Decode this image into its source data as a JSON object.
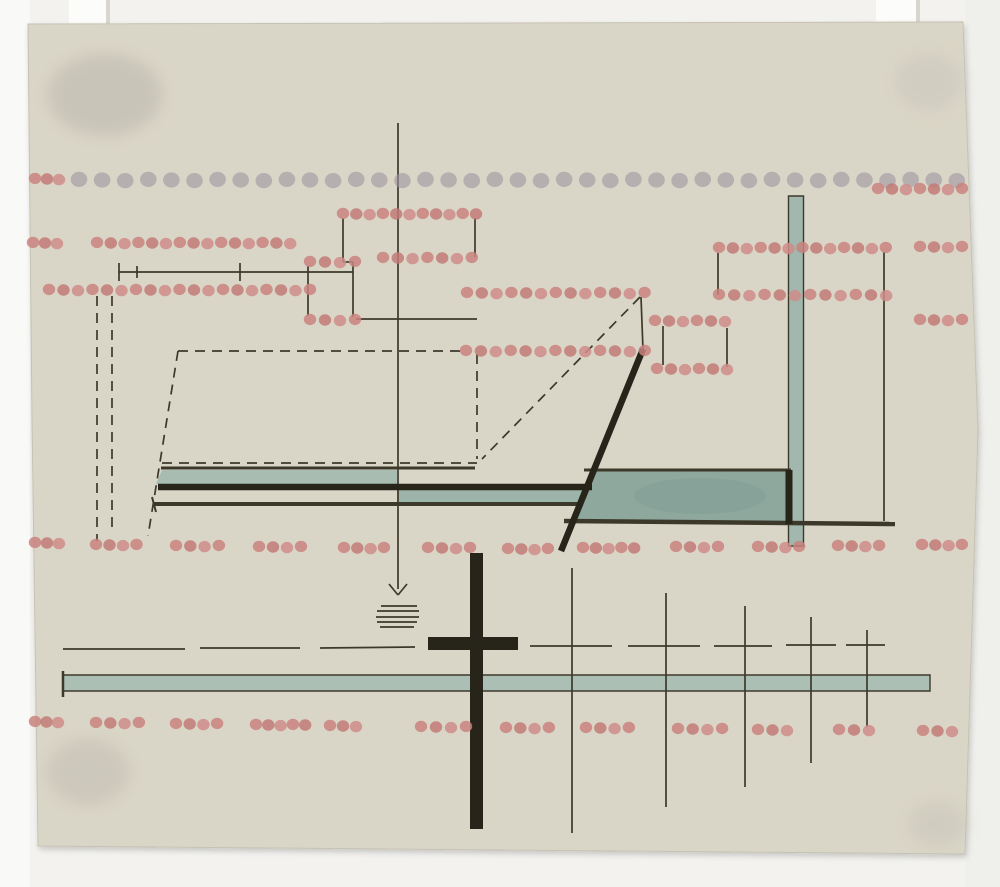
{
  "artwork": {
    "scene": {
      "width": 1000,
      "height": 887,
      "background": "#f3f2ef",
      "left_strip": "#fafaf8",
      "right_strip": "#eeedea"
    },
    "palette": {
      "ink": "#3c392b",
      "black": "#272419",
      "pink": "#c9837e",
      "pink_dark": "#c17a75",
      "pink_light": "#cf8d89",
      "gray_dot": "#9d94a0",
      "tab": "#fcfcfa",
      "tab_shadow": "#d9d6d0",
      "paper": "#dad6c7",
      "paper_edge": "#c6c2b3"
    },
    "tabs": [
      {
        "x": 69,
        "y": 0,
        "w": 41,
        "h": 28
      },
      {
        "x": 876,
        "y": 0,
        "w": 44,
        "h": 25
      }
    ],
    "paper": {
      "points": "28,24 963,22 978,430 965,854 38,846 32,420",
      "fill": "#dad6c7",
      "edge": "#c6c2b3"
    },
    "smudges": [
      {
        "cx": 105,
        "cy": 95,
        "rx": 58,
        "ry": 42,
        "fill": "#b5b0a8",
        "op": 0.45
      },
      {
        "cx": 88,
        "cy": 772,
        "rx": 42,
        "ry": 34,
        "fill": "#bdb8ae",
        "op": 0.45
      },
      {
        "cx": 928,
        "cy": 82,
        "rx": 34,
        "ry": 30,
        "fill": "#c9c5bc",
        "op": 0.5
      },
      {
        "cx": 937,
        "cy": 824,
        "rx": 30,
        "ry": 24,
        "fill": "#c6c2b8",
        "op": 0.45
      }
    ],
    "teal_shapes": [
      {
        "name": "teal-column",
        "pts": "788.5,196 803.5,196 803.5,546 788.5,546",
        "fill": "#a2b7ad",
        "stroke": true
      },
      {
        "name": "teal-bar-left",
        "pts": "162,470 397,470 397,484 156,484",
        "fill": "#a9bcb2",
        "stroke": false
      },
      {
        "name": "teal-bar-mid",
        "pts": "397,489 583,489 583,502 397,502",
        "fill": "#9cb4aa",
        "stroke": false
      },
      {
        "name": "teal-panel",
        "pts": "594,470 790,470 790,521 573,521",
        "fill": "#8ea89e",
        "stroke": false
      },
      {
        "name": "teal-bar-long",
        "pts": "63,675 930,675 930,691 63,691",
        "fill": "#abbfb4",
        "stroke": true
      }
    ],
    "teal_blotch": {
      "cx": 700,
      "cy": 496,
      "rx": 66,
      "ry": 18,
      "fill": "#7d9b93",
      "op": 0.5
    },
    "black_rects": [
      {
        "name": "cross-vertical-bar",
        "x": 470,
        "y": 553,
        "w": 13,
        "h": 276
      },
      {
        "name": "cross-horizontal-bar",
        "x": 428,
        "y": 637,
        "w": 90,
        "h": 13
      }
    ],
    "lines": {
      "solid": [
        [
          398,
          123,
          398,
          589
        ],
        [
          389,
          584,
          398,
          595
        ],
        [
          407,
          584,
          398,
          595
        ],
        [
          381,
          606,
          417,
          606
        ],
        [
          377,
          611,
          419,
          611
        ],
        [
          376,
          617,
          419,
          617
        ],
        [
          377,
          622,
          417,
          622
        ],
        [
          380,
          627,
          414,
          627
        ],
        [
          119,
          272,
          353,
          272
        ],
        [
          119,
          263,
          119,
          281
        ],
        [
          137,
          266,
          137,
          278
        ],
        [
          240,
          263,
          240,
          281
        ],
        [
          343,
          218,
          343,
          262
        ],
        [
          343,
          262,
          353,
          262
        ],
        [
          353,
          262,
          353,
          317
        ],
        [
          308,
          266,
          308,
          316
        ],
        [
          475,
          218,
          475,
          257
        ],
        [
          356,
          319,
          477,
          319
        ],
        [
          641,
          297,
          643,
          350
        ],
        [
          718,
          253,
          718,
          295
        ],
        [
          884,
          252,
          884,
          521
        ],
        [
          663,
          326,
          663,
          365
        ],
        [
          727,
          328,
          727,
          367
        ],
        [
          572,
          568,
          572,
          833
        ],
        [
          666,
          593,
          666,
          807
        ],
        [
          745,
          606,
          745,
          787
        ],
        [
          811,
          617,
          811,
          763
        ],
        [
          867,
          630,
          867,
          727
        ],
        [
          63,
          649,
          185,
          649
        ],
        [
          200,
          648,
          300,
          648
        ],
        [
          320,
          648,
          415,
          647
        ],
        [
          530,
          646,
          612,
          646
        ],
        [
          628,
          646,
          700,
          646
        ],
        [
          714,
          646,
          772,
          646
        ],
        [
          786,
          645,
          836,
          645
        ],
        [
          846,
          645,
          885,
          645
        ],
        [
          161,
          468,
          475,
          468,
          3
        ],
        [
          153,
          504,
          583,
          504,
          4
        ],
        [
          152,
          497,
          156,
          512,
          2
        ],
        [
          564,
          521,
          895,
          524,
          4.5
        ],
        [
          584,
          470,
          791,
          470,
          3
        ],
        [
          63,
          671,
          63,
          697,
          2.5
        ]
      ],
      "dashed": [
        [
          97,
          296,
          97,
          541
        ],
        [
          112,
          296,
          112,
          527
        ],
        [
          178,
          351,
          462,
          351
        ],
        [
          178,
          351,
          148,
          536
        ],
        [
          477,
          354,
          477,
          459
        ],
        [
          640,
          297,
          482,
          459
        ],
        [
          162,
          463,
          477,
          463
        ]
      ],
      "black": [
        [
          158,
          487,
          592,
          487,
          6.5
        ],
        [
          643,
          349,
          561,
          551,
          6.5
        ],
        [
          789,
          470,
          789,
          524,
          7
        ]
      ]
    },
    "dot_rows": [
      {
        "c": "gray",
        "y": 180,
        "x": 79,
        "n": 39,
        "dx": 23.1,
        "d": 16.6
      },
      {
        "c": "pink",
        "y": 179,
        "x": 35,
        "n": 3,
        "dx": 12,
        "d": 12.4
      },
      {
        "c": "pink",
        "y": 189,
        "x": 878,
        "n": 7,
        "dx": 14,
        "d": 12.4
      },
      {
        "c": "pink",
        "y": 214,
        "x": 343,
        "n": 11,
        "dx": 13.3,
        "d": 12.4
      },
      {
        "c": "pink",
        "y": 243,
        "x": 33,
        "n": 3,
        "dx": 12,
        "d": 12.4
      },
      {
        "c": "pink",
        "y": 243,
        "x": 97,
        "n": 15,
        "dx": 13.8,
        "d": 12.4
      },
      {
        "c": "pink",
        "y": 248,
        "x": 719,
        "n": 13,
        "dx": 13.9,
        "d": 12.4
      },
      {
        "c": "pink",
        "y": 247,
        "x": 920,
        "n": 4,
        "dx": 14,
        "d": 12.4
      },
      {
        "c": "pink",
        "y": 258,
        "x": 383,
        "n": 7,
        "dx": 14.8,
        "d": 12.4
      },
      {
        "c": "pink",
        "y": 262,
        "x": 310,
        "n": 4,
        "dx": 15,
        "d": 12.4
      },
      {
        "c": "pink",
        "y": 290,
        "x": 49,
        "n": 19,
        "dx": 14.5,
        "d": 12.4
      },
      {
        "c": "pink",
        "y": 293,
        "x": 467,
        "n": 13,
        "dx": 14.8,
        "d": 12.4
      },
      {
        "c": "pink",
        "y": 295,
        "x": 719,
        "n": 12,
        "dx": 15.2,
        "d": 12.4
      },
      {
        "c": "pink",
        "y": 320,
        "x": 310,
        "n": 4,
        "dx": 15,
        "d": 12.4
      },
      {
        "c": "pink",
        "y": 321,
        "x": 655,
        "n": 6,
        "dx": 14,
        "d": 12.4
      },
      {
        "c": "pink",
        "y": 320,
        "x": 920,
        "n": 4,
        "dx": 14,
        "d": 12.4
      },
      {
        "c": "pink",
        "y": 351,
        "x": 466,
        "n": 13,
        "dx": 14.9,
        "d": 12.4
      },
      {
        "c": "pink",
        "y": 369,
        "x": 657,
        "n": 6,
        "dx": 14,
        "d": 12.4
      },
      {
        "c": "pink",
        "y": 543,
        "x": 35,
        "n": 3,
        "dx": 12,
        "d": 12.4
      },
      {
        "c": "pink",
        "y": 545,
        "x": 96,
        "n": 4,
        "dx": 13.5,
        "d": 12.4
      },
      {
        "c": "pink",
        "y": 546,
        "x": 176,
        "n": 4,
        "dx": 14.3,
        "d": 12.4
      },
      {
        "c": "pink",
        "y": 547,
        "x": 259,
        "n": 4,
        "dx": 14,
        "d": 12.4
      },
      {
        "c": "pink",
        "y": 548,
        "x": 344,
        "n": 4,
        "dx": 13.3,
        "d": 12.4
      },
      {
        "c": "pink",
        "y": 548,
        "x": 428,
        "n": 4,
        "dx": 14,
        "d": 12.4
      },
      {
        "c": "pink",
        "y": 549,
        "x": 508,
        "n": 4,
        "dx": 13.3,
        "d": 12.4
      },
      {
        "c": "pink",
        "y": 548,
        "x": 583,
        "n": 5,
        "dx": 12.8,
        "d": 12.4
      },
      {
        "c": "pink",
        "y": 547,
        "x": 676,
        "n": 4,
        "dx": 14,
        "d": 12.4
      },
      {
        "c": "pink",
        "y": 547,
        "x": 758,
        "n": 4,
        "dx": 13.7,
        "d": 12.4
      },
      {
        "c": "pink",
        "y": 546,
        "x": 838,
        "n": 4,
        "dx": 13.7,
        "d": 12.4
      },
      {
        "c": "pink",
        "y": 545,
        "x": 922,
        "n": 4,
        "dx": 13.3,
        "d": 12.4
      },
      {
        "c": "pink",
        "y": 722,
        "x": 35,
        "n": 3,
        "dx": 11.5,
        "d": 12.4
      },
      {
        "c": "pink",
        "y": 723,
        "x": 96,
        "n": 4,
        "dx": 14.3,
        "d": 12.4
      },
      {
        "c": "pink",
        "y": 724,
        "x": 176,
        "n": 4,
        "dx": 13.7,
        "d": 12.4
      },
      {
        "c": "pink",
        "y": 725,
        "x": 256,
        "n": 5,
        "dx": 12.3,
        "d": 12.4
      },
      {
        "c": "pink",
        "y": 726,
        "x": 330,
        "n": 3,
        "dx": 13,
        "d": 12.4
      },
      {
        "c": "pink",
        "y": 727,
        "x": 421,
        "n": 4,
        "dx": 15,
        "d": 12.4
      },
      {
        "c": "pink",
        "y": 728,
        "x": 506,
        "n": 4,
        "dx": 14.3,
        "d": 12.4
      },
      {
        "c": "pink",
        "y": 728,
        "x": 586,
        "n": 4,
        "dx": 14.3,
        "d": 12.4
      },
      {
        "c": "pink",
        "y": 729,
        "x": 678,
        "n": 4,
        "dx": 14.7,
        "d": 12.4
      },
      {
        "c": "pink",
        "y": 730,
        "x": 758,
        "n": 3,
        "dx": 14.5,
        "d": 12.4
      },
      {
        "c": "pink",
        "y": 730,
        "x": 839,
        "n": 3,
        "dx": 15,
        "d": 12.4
      },
      {
        "c": "pink",
        "y": 731,
        "x": 923,
        "n": 3,
        "dx": 14.5,
        "d": 12.4
      }
    ]
  }
}
